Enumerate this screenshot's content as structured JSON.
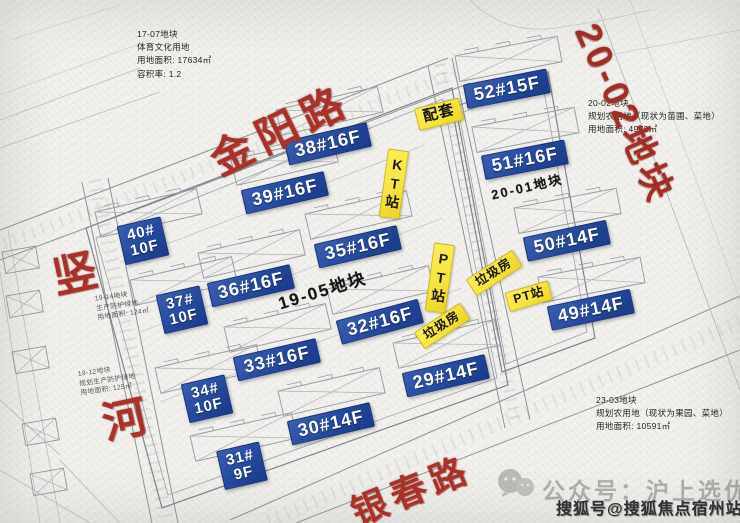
{
  "plot_labels": {
    "p1905": "19-05地块",
    "p2001": "20-01地块"
  },
  "street_labels": {
    "jinyang_road": "金阳路",
    "shu_char": "竖",
    "he_char": "河",
    "yinchun_road": "银春路",
    "plot_2002_banner": "20-02地块"
  },
  "buildings": [
    {
      "label": "38#16F"
    },
    {
      "label": "39#16F"
    },
    {
      "label": "40#\n10F"
    },
    {
      "label": "35#16F"
    },
    {
      "label": "36#16F"
    },
    {
      "label": "37#\n10F"
    },
    {
      "label": "32#16F"
    },
    {
      "label": "33#16F"
    },
    {
      "label": "34#\n10F"
    },
    {
      "label": "30#14F"
    },
    {
      "label": "31#\n9F"
    },
    {
      "label": "29#14F"
    },
    {
      "label": "52#15F"
    },
    {
      "label": "51#16F"
    },
    {
      "label": "50#14F"
    },
    {
      "label": "49#14F"
    }
  ],
  "facilities": [
    {
      "label": "配套"
    },
    {
      "label": "KT站"
    },
    {
      "label": "PT站"
    },
    {
      "label": "垃圾房"
    },
    {
      "label": "PT站"
    },
    {
      "label": "垃圾房"
    }
  ],
  "info_blocks": {
    "plot_1707": {
      "line1": "17-07地块",
      "line2": "体育文化用地",
      "line3": "用地面积: 17634㎡",
      "line4": "容积率: 1.2"
    },
    "plot_2002": {
      "line1": "20-02地块",
      "line2": "规划农用地（现状为苗圃、菜地）",
      "line3": "用地面积: 4972㎡"
    },
    "plot_2303": {
      "line1": "23-03地块",
      "line2": "规划农用地（现状为果园、菜地）",
      "line3": "用地面积: 10591㎡"
    },
    "plot_1914": {
      "line1": "19-14地块",
      "line2": "生产防护绿地",
      "line3": "用地面积: 124㎡"
    },
    "plot_1912": {
      "line1": "19-12地块",
      "line2": "规划生产防护绿地",
      "line3": "用地面积: 125㎡"
    }
  },
  "watermarks": {
    "wechat_account": "公众号：沪上选优房",
    "sohu_account": "搜狐号@搜狐焦点宿州站"
  },
  "colors": {
    "building_label_blue": "#24489b",
    "facility_label_yellow": "#f6e33a",
    "road_name_red": "#a8322a"
  }
}
